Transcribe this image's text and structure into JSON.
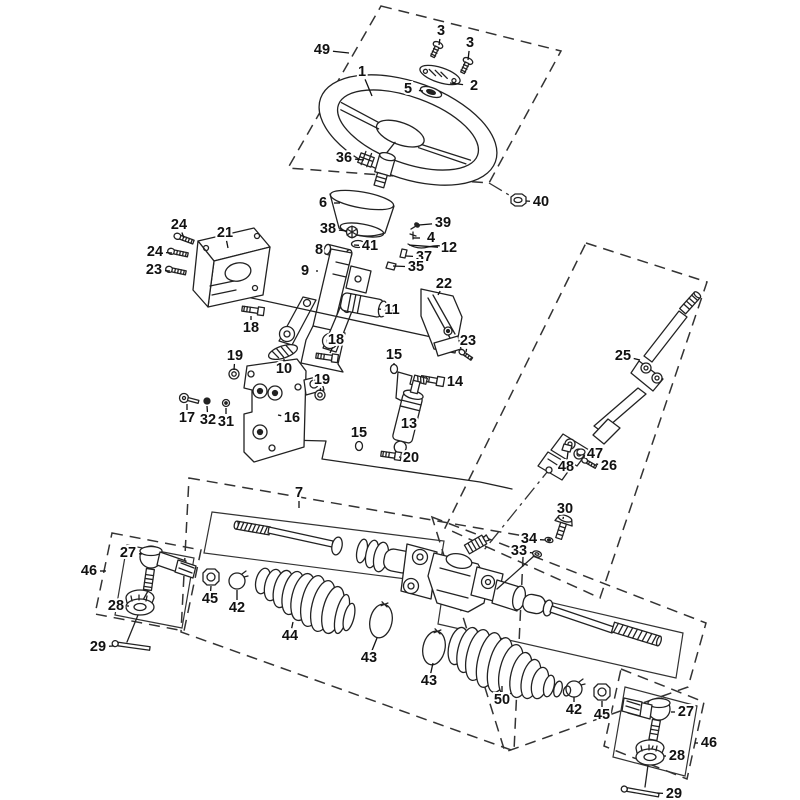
{
  "diagram": {
    "type": "exploded-parts-diagram",
    "subject": "steering-column-and-rack-assembly",
    "canvas": {
      "width": 800,
      "height": 800,
      "background": "#ffffff",
      "line_color": "#222222"
    },
    "callouts": [
      {
        "n": "49",
        "x": 322,
        "y": 50,
        "tx": 349,
        "ty": 53
      },
      {
        "n": "3",
        "x": 441,
        "y": 31,
        "tx": 439,
        "ty": 45
      },
      {
        "n": "3",
        "x": 470,
        "y": 43,
        "tx": 468,
        "ty": 60
      },
      {
        "n": "1",
        "x": 362,
        "y": 72,
        "tx": 372,
        "ty": 96
      },
      {
        "n": "5",
        "x": 408,
        "y": 89,
        "tx": 423,
        "ty": 91
      },
      {
        "n": "2",
        "x": 474,
        "y": 86,
        "tx": 450,
        "ty": 83
      },
      {
        "n": "36",
        "x": 344,
        "y": 158,
        "tx": 364,
        "ty": 160
      },
      {
        "n": "6",
        "x": 323,
        "y": 203,
        "tx": 340,
        "ty": 203
      },
      {
        "n": "40",
        "x": 541,
        "y": 202,
        "tx": 526,
        "ty": 201
      },
      {
        "n": "38",
        "x": 328,
        "y": 229,
        "tx": 347,
        "ty": 231
      },
      {
        "n": "39",
        "x": 443,
        "y": 223,
        "tx": 419,
        "ty": 225
      },
      {
        "n": "41",
        "x": 370,
        "y": 246,
        "tx": 354,
        "ty": 245
      },
      {
        "n": "4",
        "x": 431,
        "y": 238,
        "tx": 413,
        "ty": 238
      },
      {
        "n": "12",
        "x": 449,
        "y": 248,
        "tx": 409,
        "ty": 245
      },
      {
        "n": "37",
        "x": 424,
        "y": 257,
        "tx": 406,
        "ty": 256
      },
      {
        "n": "35",
        "x": 416,
        "y": 267,
        "tx": 393,
        "ty": 266
      },
      {
        "n": "8",
        "x": 319,
        "y": 250,
        "tx": 331,
        "ty": 250
      },
      {
        "n": "9",
        "x": 305,
        "y": 271,
        "tx": 318,
        "ty": 271
      },
      {
        "n": "24",
        "x": 179,
        "y": 225,
        "tx": 184,
        "ty": 238
      },
      {
        "n": "24",
        "x": 155,
        "y": 252,
        "tx": 172,
        "ty": 253
      },
      {
        "n": "23",
        "x": 154,
        "y": 270,
        "tx": 170,
        "ty": 271
      },
      {
        "n": "21",
        "x": 225,
        "y": 233,
        "tx": 228,
        "ty": 248
      },
      {
        "n": "22",
        "x": 444,
        "y": 284,
        "tx": 438,
        "ty": 295
      },
      {
        "n": "23",
        "x": 468,
        "y": 341,
        "tx": 466,
        "ty": 352
      },
      {
        "n": "11",
        "x": 392,
        "y": 310,
        "tx": 378,
        "ty": 309
      },
      {
        "n": "18",
        "x": 251,
        "y": 328,
        "tx": 251,
        "ty": 316
      },
      {
        "n": "18",
        "x": 336,
        "y": 340,
        "tx": 330,
        "ty": 353
      },
      {
        "n": "10",
        "x": 284,
        "y": 369,
        "tx": 284,
        "ty": 359
      },
      {
        "n": "19",
        "x": 235,
        "y": 356,
        "tx": 234,
        "ty": 370
      },
      {
        "n": "19",
        "x": 322,
        "y": 380,
        "tx": 320,
        "ty": 391
      },
      {
        "n": "15",
        "x": 394,
        "y": 355,
        "tx": 394,
        "ty": 365
      },
      {
        "n": "14",
        "x": 455,
        "y": 382,
        "tx": 446,
        "ty": 381
      },
      {
        "n": "17",
        "x": 187,
        "y": 418,
        "tx": 187,
        "ty": 404
      },
      {
        "n": "32",
        "x": 208,
        "y": 420,
        "tx": 207,
        "ty": 406
      },
      {
        "n": "31",
        "x": 226,
        "y": 422,
        "tx": 226,
        "ty": 408
      },
      {
        "n": "16",
        "x": 292,
        "y": 418,
        "tx": 278,
        "ty": 415
      },
      {
        "n": "13",
        "x": 409,
        "y": 424,
        "tx": 398,
        "ty": 423
      },
      {
        "n": "15",
        "x": 359,
        "y": 433,
        "tx": 359,
        "ty": 442
      },
      {
        "n": "20",
        "x": 411,
        "y": 458,
        "tx": 399,
        "ty": 457
      },
      {
        "n": "25",
        "x": 623,
        "y": 356,
        "tx": 640,
        "ty": 360
      },
      {
        "n": "47",
        "x": 595,
        "y": 454,
        "tx": 585,
        "ty": 452
      },
      {
        "n": "48",
        "x": 566,
        "y": 467,
        "tx": 568,
        "ty": 452
      },
      {
        "n": "26",
        "x": 609,
        "y": 466,
        "tx": 596,
        "ty": 464
      },
      {
        "n": "30",
        "x": 565,
        "y": 509,
        "tx": 563,
        "ty": 519
      },
      {
        "n": "34",
        "x": 529,
        "y": 539,
        "tx": 545,
        "ty": 540
      },
      {
        "n": "33",
        "x": 519,
        "y": 551,
        "tx": 533,
        "ty": 553
      },
      {
        "n": "7",
        "x": 299,
        "y": 493,
        "tx": 299,
        "ty": 508
      },
      {
        "n": "27",
        "x": 128,
        "y": 553,
        "tx": 142,
        "ty": 554
      },
      {
        "n": "46",
        "x": 89,
        "y": 571,
        "tx": 106,
        "ty": 571
      },
      {
        "n": "28",
        "x": 116,
        "y": 606,
        "tx": 129,
        "ty": 606
      },
      {
        "n": "45",
        "x": 210,
        "y": 599,
        "tx": 211,
        "ty": 586
      },
      {
        "n": "42",
        "x": 237,
        "y": 608,
        "tx": 237,
        "ty": 590
      },
      {
        "n": "29",
        "x": 98,
        "y": 647,
        "tx": 113,
        "ty": 646
      },
      {
        "n": "44",
        "x": 290,
        "y": 636,
        "tx": 293,
        "ty": 622
      },
      {
        "n": "43",
        "x": 369,
        "y": 658,
        "tx": 377,
        "ty": 638
      },
      {
        "n": "43",
        "x": 429,
        "y": 681,
        "tx": 433,
        "ty": 663
      },
      {
        "n": "50",
        "x": 502,
        "y": 700,
        "tx": 502,
        "ty": 686
      },
      {
        "n": "42",
        "x": 574,
        "y": 710,
        "tx": 574,
        "ty": 697
      },
      {
        "n": "45",
        "x": 602,
        "y": 715,
        "tx": 602,
        "ty": 701
      },
      {
        "n": "27",
        "x": 686,
        "y": 712,
        "tx": 671,
        "ty": 712
      },
      {
        "n": "46",
        "x": 709,
        "y": 743,
        "tx": 695,
        "ty": 743
      },
      {
        "n": "28",
        "x": 677,
        "y": 756,
        "tx": 664,
        "ty": 756
      },
      {
        "n": "29",
        "x": 674,
        "y": 794,
        "tx": 657,
        "ty": 793
      }
    ],
    "frame_boxes": [
      {
        "name": "group-box-49",
        "style": "dashed",
        "points": [
          [
            381,
            6
          ],
          [
            561,
            51
          ],
          [
            489,
            183
          ],
          [
            288,
            168
          ]
        ]
      },
      {
        "name": "group-box-25",
        "style": "dashed",
        "points": [
          [
            586,
            243
          ],
          [
            707,
            282
          ],
          [
            600,
            598
          ],
          [
            445,
            528
          ]
        ]
      },
      {
        "name": "group-box-7-left",
        "style": "dashed",
        "points": [
          [
            189,
            478
          ],
          [
            524,
            536
          ],
          [
            514,
            751
          ],
          [
            181,
            632
          ]
        ]
      },
      {
        "name": "group-box-7-right",
        "style": "dashed",
        "points": [
          [
            432,
            517
          ],
          [
            706,
            623
          ],
          [
            688,
            687
          ],
          [
            505,
            752
          ]
        ]
      },
      {
        "name": "group-box-46-left",
        "style": "dashed",
        "points": [
          [
            112,
            533
          ],
          [
            201,
            550
          ],
          [
            184,
            631
          ],
          [
            95,
            614
          ]
        ]
      },
      {
        "name": "group-box-46-right",
        "style": "dashed",
        "points": [
          [
            621,
            669
          ],
          [
            704,
            702
          ],
          [
            687,
            779
          ],
          [
            604,
            746
          ]
        ]
      },
      {
        "name": "inner-box-rack-left",
        "style": "solid",
        "points": [
          [
            212,
            512
          ],
          [
            444,
            541
          ],
          [
            437,
            583
          ],
          [
            204,
            553
          ]
        ]
      },
      {
        "name": "inner-box-rack-right",
        "style": "solid",
        "points": [
          [
            445,
            578
          ],
          [
            683,
            633
          ],
          [
            676,
            678
          ],
          [
            438,
            624
          ]
        ]
      },
      {
        "name": "inner-box-46-left",
        "style": "solid",
        "points": [
          [
            127,
            545
          ],
          [
            194,
            558
          ],
          [
            182,
            628
          ],
          [
            115,
            615
          ]
        ]
      },
      {
        "name": "inner-box-46-right",
        "style": "solid",
        "points": [
          [
            625,
            687
          ],
          [
            697,
            706
          ],
          [
            685,
            776
          ],
          [
            613,
            757
          ]
        ]
      }
    ],
    "centerlines": [
      {
        "name": "centerline-to-nut-40",
        "points": [
          [
            489,
            183
          ],
          [
            514,
            198
          ]
        ]
      },
      {
        "name": "centerline-shaft-to-pinion",
        "points": [
          [
            552,
            466
          ],
          [
            484,
            550
          ]
        ]
      }
    ]
  }
}
